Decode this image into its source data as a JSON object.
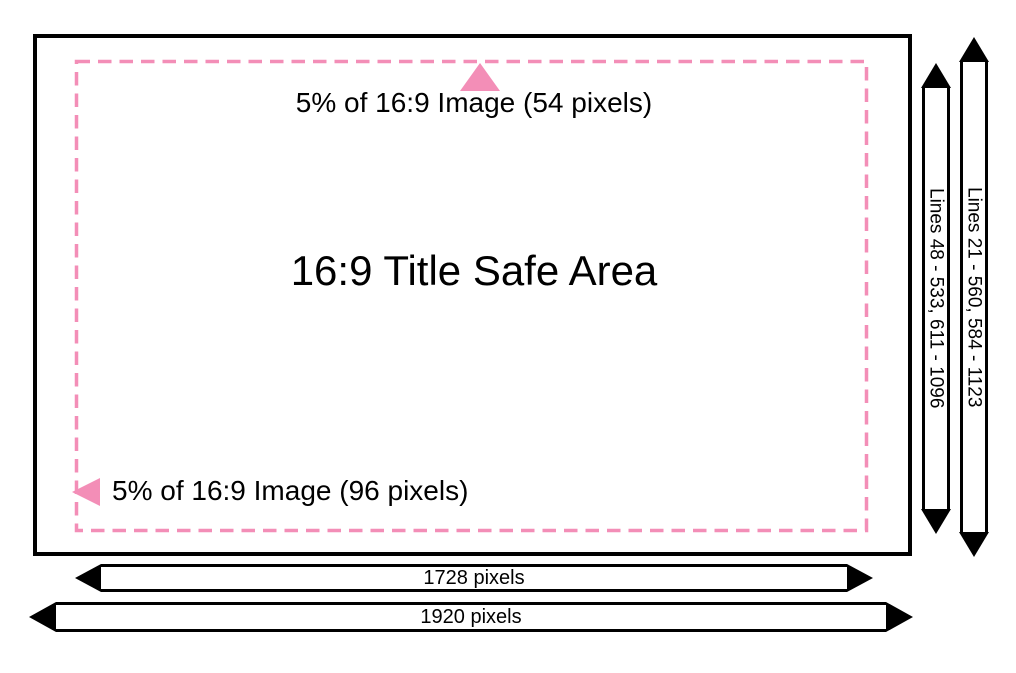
{
  "diagram": {
    "title": "16:9 Title Safe Area",
    "annotations": {
      "top_margin": "5% of 16:9 Image (54 pixels)",
      "left_margin": "5% of 16:9 Image (96 pixels)"
    },
    "dimensions": {
      "safe_lines": "Lines 48 - 533, 611 - 1096",
      "full_lines": "Lines 21 - 560, 584 - 1123",
      "safe_width": "1728 pixels",
      "full_width": "1920 pixels"
    },
    "colors": {
      "accent_pink": "#F38EB7",
      "ink": "#000000",
      "background": "#FFFFFF"
    },
    "icons": {
      "top_marker": "up-triangle-icon",
      "left_marker": "left-triangle-icon",
      "vertical_dimension": "double-headed-vertical-arrow",
      "horizontal_dimension": "double-headed-horizontal-arrow"
    }
  }
}
